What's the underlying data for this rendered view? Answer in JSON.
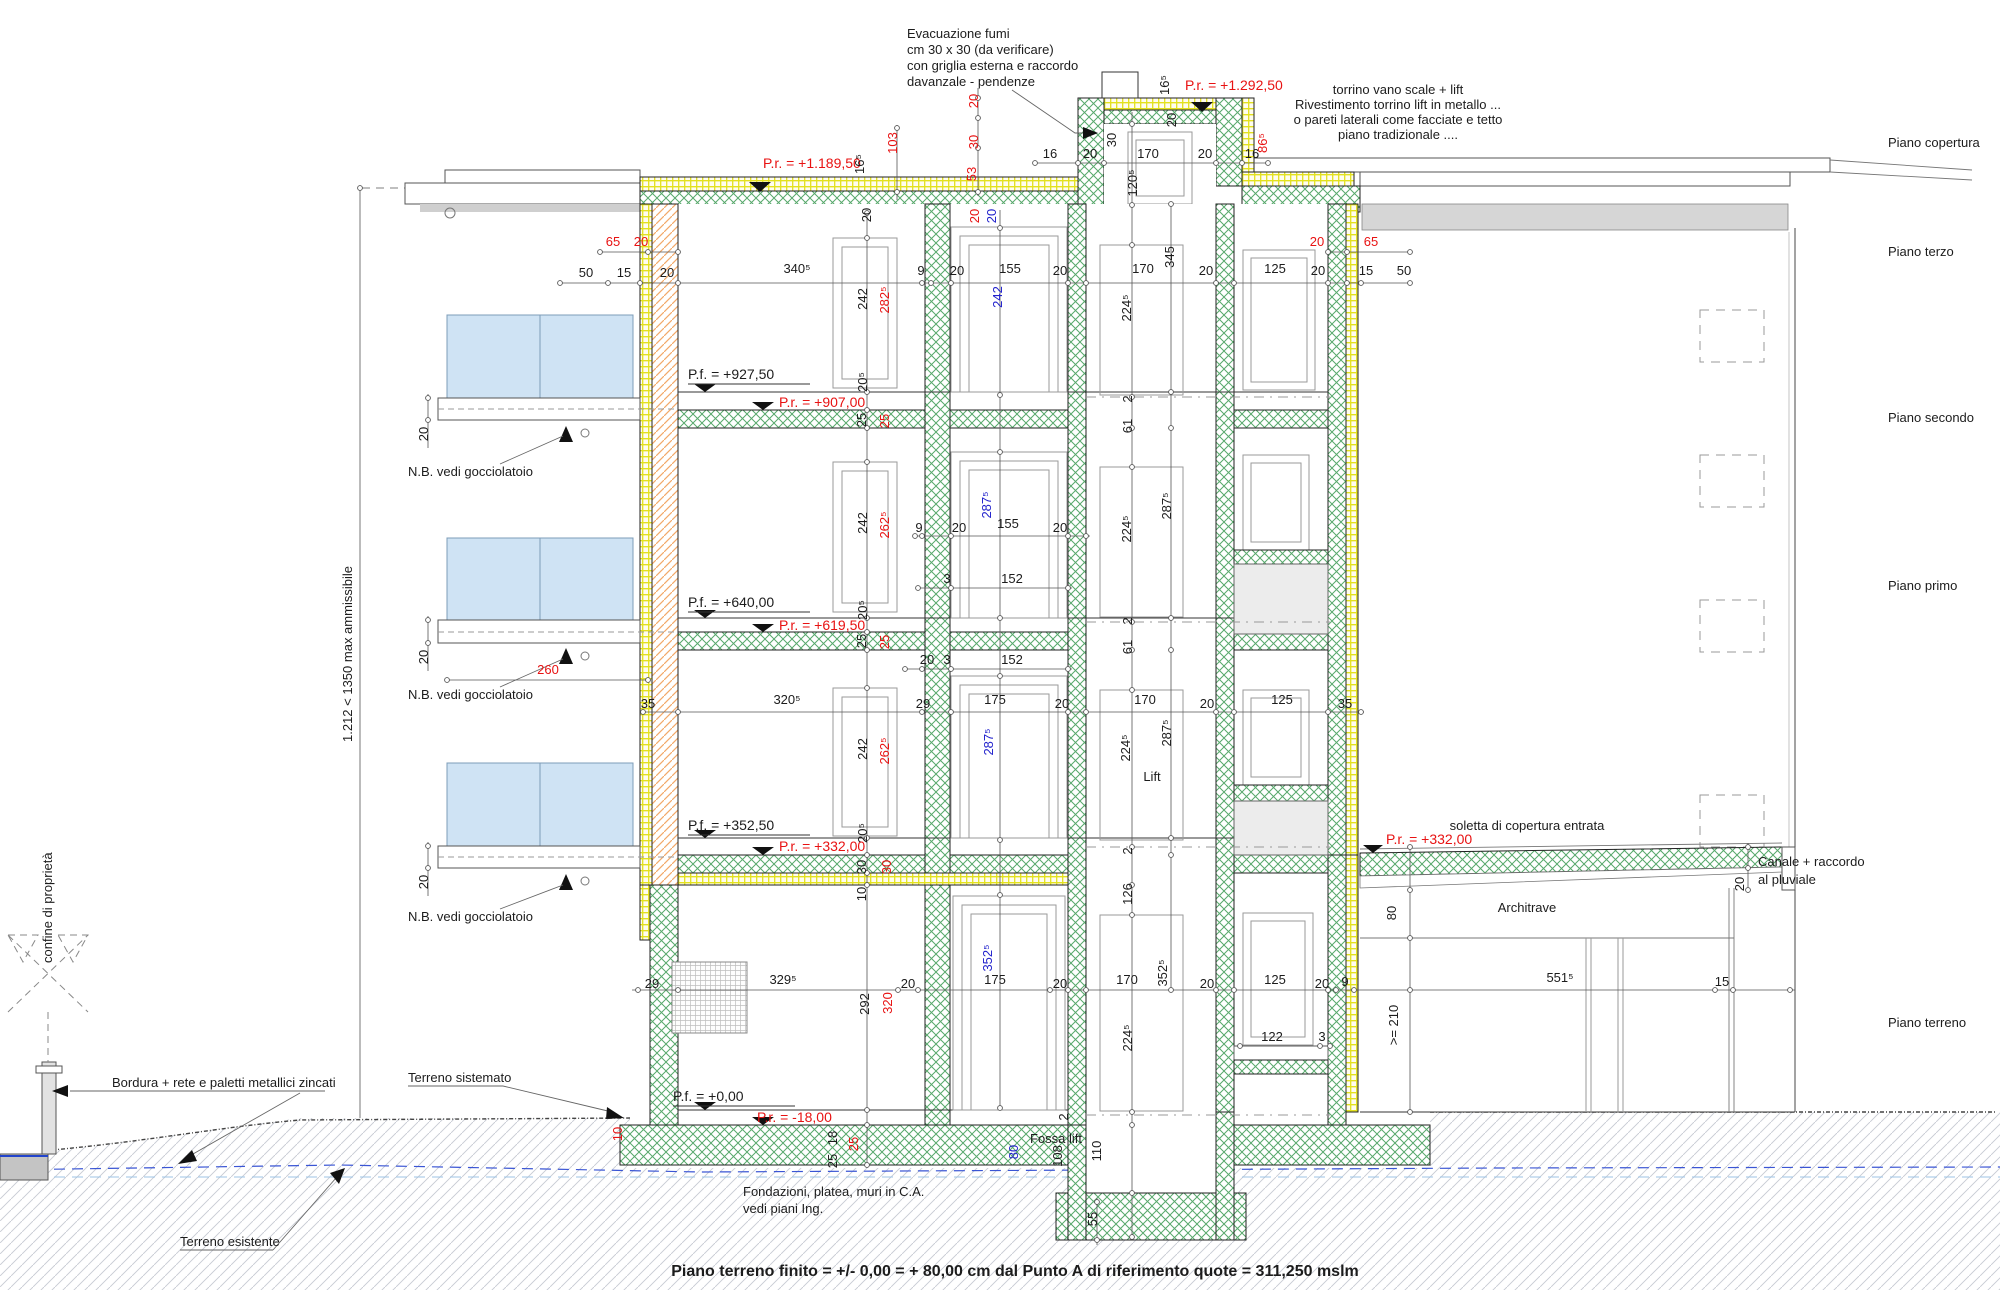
{
  "drawing": {
    "type": "architectural-building-section",
    "language": "Italian",
    "bottom_note": "Piano terreno finito = +/- 0,00 = + 80,00 cm dal Punto A di riferimento quote = 311,250 mslm"
  },
  "colors": {
    "ink": "#1c1c1c",
    "red": "#e81212",
    "blue": "#2222cc",
    "insulation_green": "#57a86b",
    "brick_yellow": "#e3e11e",
    "brick_orange": "#f2a868",
    "glass_blue": "#cfe3f4"
  },
  "floors": [
    "Piano copertura",
    "Piano terzo",
    "Piano secondo",
    "Piano primo",
    "Piano terreno"
  ],
  "levels": {
    "roof_pr": "P.r. = +1.189,50",
    "torrino_pr": "P.r. = +1.292,50",
    "terzo_pf": "P.f. = +927,50",
    "terzo_pr": "P.r. = +907,00",
    "secondo_pf": "P.f. = +640,00",
    "secondo_pr": "P.r. = +619,50",
    "primo_pf": "P.f. = +352,50",
    "primo_pr": "P.r. = +332,00",
    "entrata_pr": "P.r. = +332,00",
    "terreno_pf": "P.f. = +0,00",
    "terreno_pr": "P.r. = -18,00"
  },
  "labels": [
    {
      "t": "Evacuazione fumi",
      "x": 907,
      "y": 38,
      "a": "s"
    },
    {
      "t": "cm 30 x 30 (da verificare)",
      "x": 907,
      "y": 54,
      "a": "s"
    },
    {
      "t": "con griglia esterna e raccordo",
      "x": 907,
      "y": 70,
      "a": "s"
    },
    {
      "t": "davanzale - pendenze",
      "x": 907,
      "y": 86,
      "a": "s"
    },
    {
      "t": "P.r. = +1.292,50",
      "x": 1185,
      "y": 90,
      "a": "s",
      "c": "red",
      "s": 14
    },
    {
      "t": "torrino vano scale + lift",
      "x": 1398,
      "y": 94
    },
    {
      "t": "Rivestimento torrino lift in metallo ...",
      "x": 1398,
      "y": 109
    },
    {
      "t": "o pareti laterali come facciate e tetto",
      "x": 1398,
      "y": 124
    },
    {
      "t": "piano tradizionale ....",
      "x": 1398,
      "y": 139
    },
    {
      "t": "P.r. = +1.189,50",
      "x": 763,
      "y": 168,
      "a": "s",
      "c": "red",
      "s": 14
    },
    {
      "t": "Piano copertura",
      "x": 1888,
      "y": 147,
      "a": "s"
    },
    {
      "t": "Piano terzo",
      "x": 1888,
      "y": 256,
      "a": "s"
    },
    {
      "t": "Piano secondo",
      "x": 1888,
      "y": 422,
      "a": "s"
    },
    {
      "t": "Piano primo",
      "x": 1888,
      "y": 590,
      "a": "s"
    },
    {
      "t": "Piano terreno",
      "x": 1888,
      "y": 1027,
      "a": "s"
    },
    {
      "t": "N.B. vedi gocciolatoio",
      "x": 408,
      "y": 476,
      "a": "s"
    },
    {
      "t": "N.B. vedi gocciolatoio",
      "x": 408,
      "y": 699,
      "a": "s"
    },
    {
      "t": "N.B. vedi gocciolatoio",
      "x": 408,
      "y": 921,
      "a": "s"
    },
    {
      "t": "confine di proprietà",
      "x": 52,
      "y": 963,
      "a": "s",
      "r": -90
    },
    {
      "t": "1.212 < 1350 max ammissibile",
      "x": 352,
      "y": 742,
      "a": "s",
      "r": -90
    },
    {
      "t": "Bordura + rete e paletti metallici zincati",
      "x": 112,
      "y": 1087,
      "a": "s"
    },
    {
      "t": "Terreno sistemato",
      "x": 408,
      "y": 1082,
      "a": "s"
    },
    {
      "t": "Terreno esistente",
      "x": 180,
      "y": 1246,
      "a": "s"
    },
    {
      "t": "P.f. = +927,50",
      "x": 688,
      "y": 379,
      "a": "s",
      "s": 14
    },
    {
      "t": "P.r. = +907,00",
      "x": 779,
      "y": 407,
      "a": "s",
      "c": "red",
      "s": 14
    },
    {
      "t": "P.f. = +640,00",
      "x": 688,
      "y": 607,
      "a": "s",
      "s": 14
    },
    {
      "t": "P.r. = +619,50",
      "x": 779,
      "y": 630,
      "a": "s",
      "c": "red",
      "s": 14
    },
    {
      "t": "P.f. = +352,50",
      "x": 688,
      "y": 830,
      "a": "s",
      "s": 14
    },
    {
      "t": "P.r. = +332,00",
      "x": 779,
      "y": 851,
      "a": "s",
      "c": "red",
      "s": 14
    },
    {
      "t": "P.r. = +332,00",
      "x": 1386,
      "y": 844,
      "a": "s",
      "c": "red",
      "s": 14
    },
    {
      "t": "P.f. = +0,00",
      "x": 673,
      "y": 1101,
      "a": "s",
      "s": 14
    },
    {
      "t": "P.r. = -18,00",
      "x": 757,
      "y": 1122,
      "a": "s",
      "c": "red",
      "s": 14
    },
    {
      "t": "soletta di copertura entrata",
      "x": 1527,
      "y": 830
    },
    {
      "t": "Canale + raccordo",
      "x": 1758,
      "y": 866,
      "a": "s"
    },
    {
      "t": "al pluviale",
      "x": 1758,
      "y": 884,
      "a": "s"
    },
    {
      "t": "Architrave",
      "x": 1527,
      "y": 912
    },
    {
      "t": "Lift",
      "x": 1152,
      "y": 781
    },
    {
      "t": "Fossa lift",
      "x": 1030,
      "y": 1143,
      "a": "s"
    },
    {
      "t": "Fondazioni, platea, muri in C.A.",
      "x": 743,
      "y": 1196,
      "a": "s"
    },
    {
      "t": "vedi piani Ing.",
      "x": 743,
      "y": 1213,
      "a": "s"
    },
    {
      "t": "Piano terreno finito = +/- 0,00 = + 80,00 cm dal Punto A di riferimento quote = 311,250 mslm",
      "x": 1015,
      "y": 1276,
      "w": "b",
      "s": 16
    },
    {
      "t": "50",
      "x": 586,
      "y": 277
    },
    {
      "t": "15",
      "x": 624,
      "y": 277
    },
    {
      "t": "20",
      "x": 667,
      "y": 277
    },
    {
      "t": "340⁵",
      "x": 797,
      "y": 273
    },
    {
      "t": "9",
      "x": 921,
      "y": 275
    },
    {
      "t": "20",
      "x": 957,
      "y": 275
    },
    {
      "t": "155",
      "x": 1010,
      "y": 273
    },
    {
      "t": "20",
      "x": 1060,
      "y": 275
    },
    {
      "t": "170",
      "x": 1143,
      "y": 273
    },
    {
      "t": "20",
      "x": 1206,
      "y": 275
    },
    {
      "t": "125",
      "x": 1275,
      "y": 273
    },
    {
      "t": "20",
      "x": 1318,
      "y": 275
    },
    {
      "t": "15",
      "x": 1366,
      "y": 275
    },
    {
      "t": "50",
      "x": 1404,
      "y": 275
    },
    {
      "t": "345",
      "x": 1174,
      "y": 257,
      "r": -90
    },
    {
      "t": "65",
      "x": 613,
      "y": 246,
      "c": "red"
    },
    {
      "t": "20",
      "x": 641,
      "y": 246,
      "c": "red"
    },
    {
      "t": "20",
      "x": 1317,
      "y": 246,
      "c": "red"
    },
    {
      "t": "65",
      "x": 1371,
      "y": 246,
      "c": "red"
    },
    {
      "t": "103",
      "x": 897,
      "y": 143,
      "r": -90,
      "c": "red"
    },
    {
      "t": "20",
      "x": 978,
      "y": 101,
      "r": -90,
      "c": "red"
    },
    {
      "t": "30",
      "x": 978,
      "y": 142,
      "r": -90,
      "c": "red"
    },
    {
      "t": "53",
      "x": 976,
      "y": 174,
      "r": -90,
      "c": "red"
    },
    {
      "t": "16⁵",
      "x": 864,
      "y": 164,
      "r": -90
    },
    {
      "t": "20",
      "x": 871,
      "y": 215,
      "r": -90
    },
    {
      "t": "20",
      "x": 979,
      "y": 216,
      "r": -90,
      "c": "red"
    },
    {
      "t": "20",
      "x": 996,
      "y": 216,
      "r": -90,
      "c": "blue"
    },
    {
      "t": "16",
      "x": 1050,
      "y": 158
    },
    {
      "t": "20",
      "x": 1090,
      "y": 158
    },
    {
      "t": "30",
      "x": 1116,
      "y": 140,
      "r": -90
    },
    {
      "t": "170",
      "x": 1148,
      "y": 158
    },
    {
      "t": "20",
      "x": 1205,
      "y": 158
    },
    {
      "t": "16",
      "x": 1252,
      "y": 158
    },
    {
      "t": "86⁵",
      "x": 1267,
      "y": 143,
      "r": -90,
      "c": "red"
    },
    {
      "t": "16⁵",
      "x": 1169,
      "y": 85,
      "r": -90
    },
    {
      "t": "20",
      "x": 1176,
      "y": 120,
      "r": -90
    },
    {
      "t": "120⁵",
      "x": 1137,
      "y": 183,
      "r": -90
    },
    {
      "t": "242",
      "x": 867,
      "y": 299,
      "r": -90
    },
    {
      "t": "282⁵",
      "x": 889,
      "y": 300,
      "r": -90,
      "c": "red"
    },
    {
      "t": "242",
      "x": 1002,
      "y": 297,
      "r": -90,
      "c": "blue"
    },
    {
      "t": "224⁵",
      "x": 1131,
      "y": 308,
      "r": -90
    },
    {
      "t": "20⁵",
      "x": 867,
      "y": 382,
      "r": -90
    },
    {
      "t": "25",
      "x": 866,
      "y": 420,
      "r": -90
    },
    {
      "t": "25",
      "x": 889,
      "y": 421,
      "r": -90,
      "c": "red"
    },
    {
      "t": "2",
      "x": 1132,
      "y": 399,
      "r": -90
    },
    {
      "t": "61",
      "x": 1132,
      "y": 426,
      "r": -90
    },
    {
      "t": "9",
      "x": 919,
      "y": 532
    },
    {
      "t": "20",
      "x": 959,
      "y": 532
    },
    {
      "t": "155",
      "x": 1008,
      "y": 528
    },
    {
      "t": "20",
      "x": 1060,
      "y": 532
    },
    {
      "t": "3",
      "x": 947,
      "y": 583
    },
    {
      "t": "152",
      "x": 1012,
      "y": 583
    },
    {
      "t": "242",
      "x": 867,
      "y": 523,
      "r": -90
    },
    {
      "t": "262⁵",
      "x": 889,
      "y": 525,
      "r": -90,
      "c": "red"
    },
    {
      "t": "287⁵",
      "x": 991,
      "y": 505,
      "r": -90,
      "c": "blue"
    },
    {
      "t": "224⁵",
      "x": 1131,
      "y": 529,
      "r": -90
    },
    {
      "t": "287⁵",
      "x": 1171,
      "y": 506,
      "r": -90
    },
    {
      "t": "20⁵",
      "x": 867,
      "y": 610,
      "r": -90
    },
    {
      "t": "25",
      "x": 866,
      "y": 641,
      "r": -90
    },
    {
      "t": "25",
      "x": 889,
      "y": 642,
      "r": -90,
      "c": "red"
    },
    {
      "t": "2",
      "x": 1132,
      "y": 621,
      "r": -90
    },
    {
      "t": "61",
      "x": 1132,
      "y": 647,
      "r": -90
    },
    {
      "t": "35",
      "x": 648,
      "y": 708
    },
    {
      "t": "320⁵",
      "x": 787,
      "y": 704
    },
    {
      "t": "29",
      "x": 923,
      "y": 708
    },
    {
      "t": "175",
      "x": 995,
      "y": 704
    },
    {
      "t": "20",
      "x": 1062,
      "y": 708
    },
    {
      "t": "170",
      "x": 1145,
      "y": 704
    },
    {
      "t": "20",
      "x": 1207,
      "y": 708
    },
    {
      "t": "125",
      "x": 1282,
      "y": 704
    },
    {
      "t": "35",
      "x": 1345,
      "y": 708
    },
    {
      "t": "260",
      "x": 548,
      "y": 674,
      "c": "red"
    },
    {
      "t": "20",
      "x": 927,
      "y": 664
    },
    {
      "t": "3",
      "x": 947,
      "y": 664
    },
    {
      "t": "152",
      "x": 1012,
      "y": 664
    },
    {
      "t": "242",
      "x": 867,
      "y": 749,
      "r": -90
    },
    {
      "t": "262⁵",
      "x": 889,
      "y": 751,
      "r": -90,
      "c": "red"
    },
    {
      "t": "287⁵",
      "x": 993,
      "y": 742,
      "r": -90,
      "c": "blue"
    },
    {
      "t": "224⁵",
      "x": 1130,
      "y": 748,
      "r": -90
    },
    {
      "t": "287⁵",
      "x": 1171,
      "y": 733,
      "r": -90
    },
    {
      "t": "20⁵",
      "x": 867,
      "y": 833,
      "r": -90
    },
    {
      "t": "30",
      "x": 866,
      "y": 867,
      "r": -90
    },
    {
      "t": "30",
      "x": 891,
      "y": 867,
      "r": -90,
      "c": "red"
    },
    {
      "t": "10",
      "x": 866,
      "y": 894,
      "r": -90
    },
    {
      "t": "2",
      "x": 1132,
      "y": 851,
      "r": -90
    },
    {
      "t": "126",
      "x": 1132,
      "y": 894,
      "r": -90
    },
    {
      "t": "80",
      "x": 1396,
      "y": 913,
      "r": -90
    },
    {
      "t": "20",
      "x": 1744,
      "y": 884,
      "r": -90
    },
    {
      "t": "20",
      "x": 428,
      "y": 434,
      "r": -90
    },
    {
      "t": "20",
      "x": 428,
      "y": 657,
      "r": -90
    },
    {
      "t": "20",
      "x": 428,
      "y": 882,
      "r": -90
    },
    {
      "t": "29",
      "x": 652,
      "y": 988
    },
    {
      "t": "329⁵",
      "x": 783,
      "y": 984
    },
    {
      "t": "20",
      "x": 908,
      "y": 988
    },
    {
      "t": "175",
      "x": 995,
      "y": 984
    },
    {
      "t": "20",
      "x": 1060,
      "y": 988
    },
    {
      "t": "170",
      "x": 1127,
      "y": 984
    },
    {
      "t": "352⁵",
      "x": 1167,
      "y": 973,
      "r": -90
    },
    {
      "t": "20",
      "x": 1207,
      "y": 988
    },
    {
      "t": "125",
      "x": 1275,
      "y": 984
    },
    {
      "t": "20",
      "x": 1322,
      "y": 988
    },
    {
      "t": "9",
      "x": 1345,
      "y": 986
    },
    {
      "t": "551⁵",
      "x": 1560,
      "y": 982
    },
    {
      "t": "15",
      "x": 1722,
      "y": 986
    },
    {
      "t": "352⁵",
      "x": 992,
      "y": 958,
      "r": -90,
      "c": "blue"
    },
    {
      "t": "292",
      "x": 869,
      "y": 1004,
      "r": -90
    },
    {
      "t": "320",
      "x": 892,
      "y": 1003,
      "r": -90,
      "c": "red"
    },
    {
      "t": "224⁵",
      "x": 1132,
      "y": 1038,
      "r": -90
    },
    {
      "t": ">= 210",
      "x": 1398,
      "y": 1025,
      "r": -90
    },
    {
      "t": "122",
      "x": 1272,
      "y": 1041
    },
    {
      "t": "3",
      "x": 1322,
      "y": 1041
    },
    {
      "t": "2",
      "x": 1068,
      "y": 1117,
      "r": -90
    },
    {
      "t": "25",
      "x": 837,
      "y": 1161,
      "r": -90
    },
    {
      "t": "18",
      "x": 837,
      "y": 1138,
      "r": -90
    },
    {
      "t": "25",
      "x": 858,
      "y": 1144,
      "r": -90,
      "c": "red"
    },
    {
      "t": "10",
      "x": 622,
      "y": 1134,
      "r": -90,
      "c": "red"
    },
    {
      "t": "80",
      "x": 1018,
      "y": 1152,
      "r": -90,
      "c": "blue"
    },
    {
      "t": "108",
      "x": 1062,
      "y": 1156,
      "r": -90
    },
    {
      "t": "110",
      "x": 1101,
      "y": 1151,
      "r": -90
    },
    {
      "t": "55",
      "x": 1097,
      "y": 1219,
      "r": -90
    }
  ]
}
